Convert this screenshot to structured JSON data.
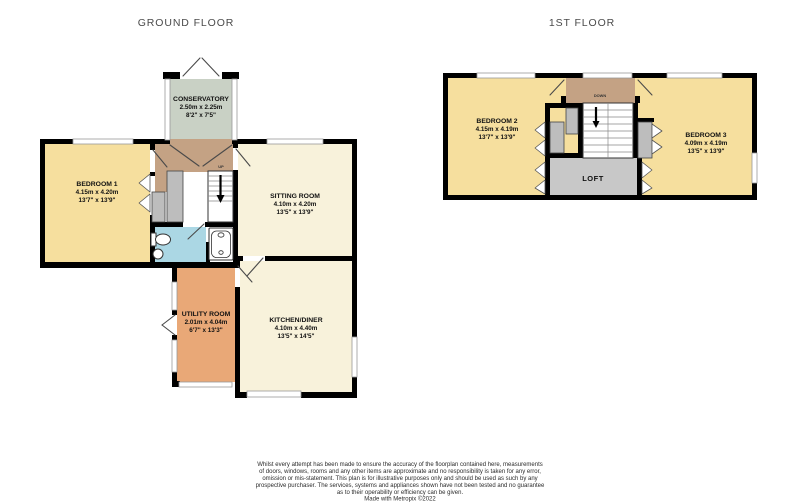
{
  "titles": {
    "ground": "GROUND FLOOR",
    "first": "1ST FLOOR"
  },
  "ground_floor": {
    "conservatory": {
      "name": "CONSERVATORY",
      "metric": "2.50m x 2.25m",
      "imperial": "8'2\" x 7'5\""
    },
    "bedroom1": {
      "name": "BEDROOM 1",
      "metric": "4.15m x 4.20m",
      "imperial": "13'7\" x 13'9\""
    },
    "sitting_room": {
      "name": "SITTING ROOM",
      "metric": "4.10m x 4.20m",
      "imperial": "13'5\" x 13'9\""
    },
    "utility_room": {
      "name": "UTILITY ROOM",
      "metric": "2.01m x 4.04m",
      "imperial": "6'7\" x 13'3\""
    },
    "kitchen_diner": {
      "name": "KITCHEN/DINER",
      "metric": "4.10m x 4.40m",
      "imperial": "13'5\" x 14'5\""
    },
    "stairs_label": "UP"
  },
  "first_floor": {
    "bedroom2": {
      "name": "BEDROOM 2",
      "metric": "4.15m x 4.19m",
      "imperial": "13'7\" x 13'9\""
    },
    "bedroom3": {
      "name": "BEDROOM 3",
      "metric": "4.09m x 4.19m",
      "imperial": "13'5\" x 13'9\""
    },
    "loft": {
      "name": "LOFT"
    },
    "stairs_label": "DOWN"
  },
  "disclaimer": {
    "lines": [
      "Whilst every attempt has been made to ensure the accuracy of the floorplan contained here, measurements",
      "of doors, windows, rooms and any other items are approximate and no responsibility is taken for any error,",
      "omission or mis-statement. This plan is for illustrative purposes only and should be used as such by any",
      "prospective purchaser. The services, systems and appliances shown have not been tested and no guarantee",
      "as to their operability or efficiency can be given.",
      "Made with Metropix ©2022"
    ]
  },
  "colors": {
    "bedroom_yellow": "#F6DF9E",
    "living_cream": "#F8F2DB",
    "utility_orange": "#E9A877",
    "hall_tan": "#C4A284",
    "conservatory_green": "#C9D1C5",
    "bathroom_blue": "#ABD7E4",
    "closet_gray": "#BDBDBD",
    "loft_gray": "#C8C8C8",
    "wall_black": "#000000",
    "title_gray": "#4A4A4A"
  }
}
